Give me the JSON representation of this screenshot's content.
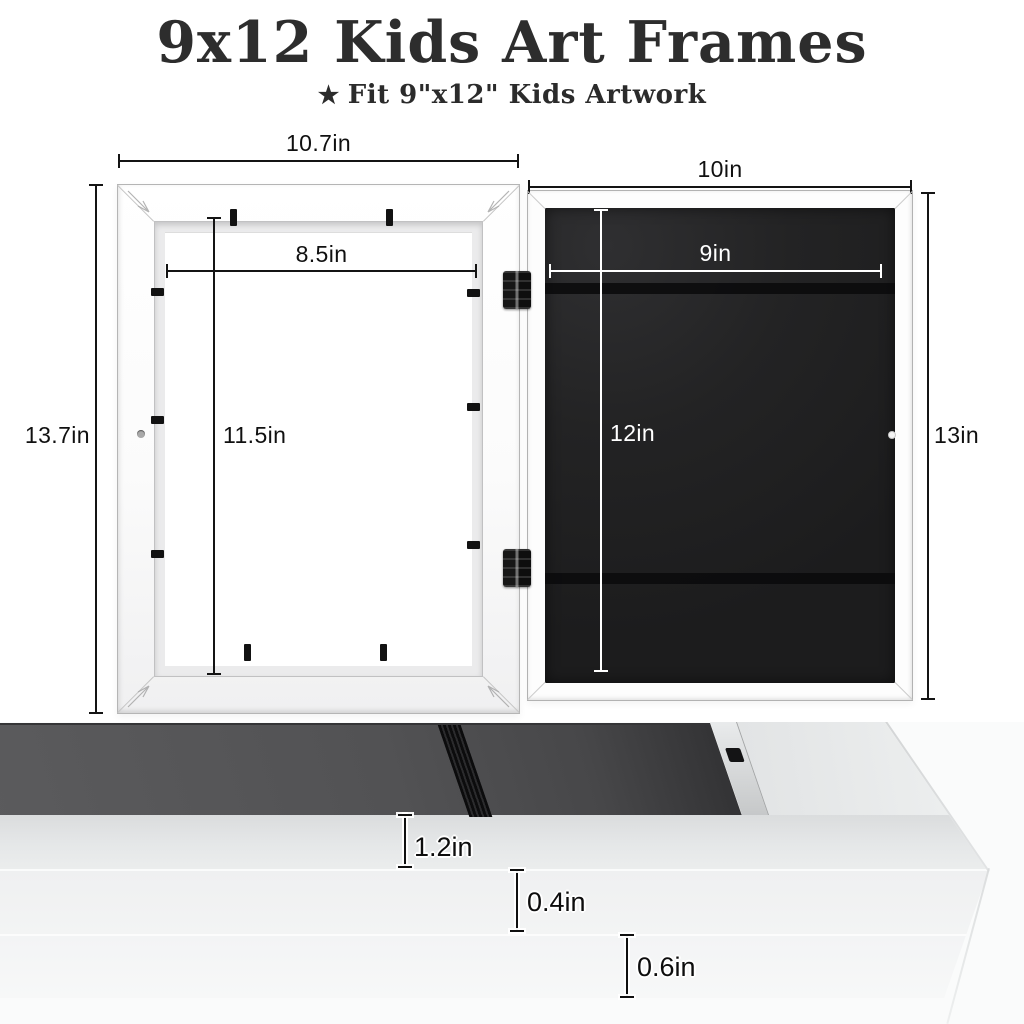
{
  "header": {
    "title": "9x12 Kids Art Frames",
    "star": "★",
    "subtitle": "Fit 9\"x12\" Kids Artwork"
  },
  "front_frame_diagram": {
    "outer_width": "10.7in",
    "outer_height": "13.7in",
    "opening_width": "8.5in",
    "opening_height": "11.5in"
  },
  "back_frame_diagram": {
    "outer_width": "10in",
    "outer_height": "13in",
    "board_width": "9in",
    "board_height": "12in"
  },
  "profile_photo": {
    "front_height": "1.2in",
    "middle_step": "0.4in",
    "back_step": "0.6in"
  },
  "colors": {
    "background": "#ffffff",
    "heading_text": "#2d2d2d",
    "dimension_line": "#141414",
    "dimension_line_light": "#ffffff",
    "frame_white": "#fbfbfb",
    "backing_board_black": "#1c1c1d",
    "photo_backing_gray": "#525254"
  }
}
